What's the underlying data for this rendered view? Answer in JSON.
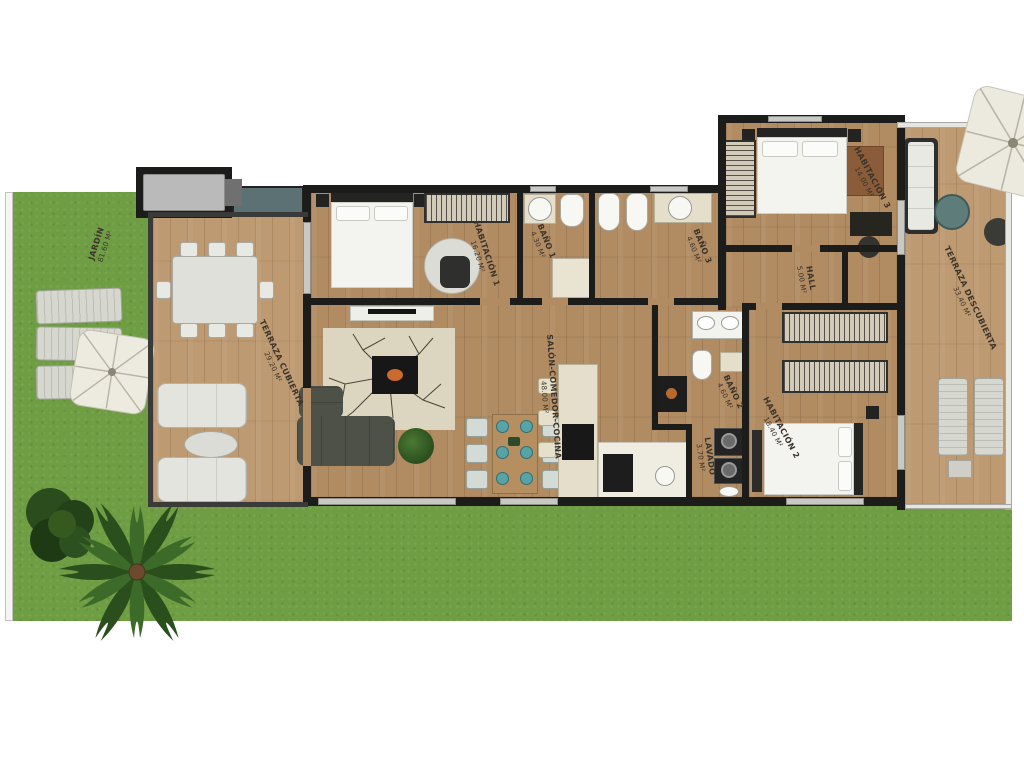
{
  "title": "Apartment floor plan",
  "rooms": [
    {
      "id": "jardin",
      "label": "JARDÍN",
      "area": "81.60 m²"
    },
    {
      "id": "terraza-cubierta",
      "label": "TERRAZA CUBIERTA",
      "area": "29.20 m²"
    },
    {
      "id": "habitacion-1",
      "label": "HABITACIÓN 1",
      "area": "16.20 m²"
    },
    {
      "id": "bano-1",
      "label": "BAÑO 1",
      "area": "4.30 m²"
    },
    {
      "id": "bano-3",
      "label": "BAÑO 3",
      "area": "4.60 m²"
    },
    {
      "id": "habitacion-3",
      "label": "HABITACIÓN 3",
      "area": "14.00 m²"
    },
    {
      "id": "hall",
      "label": "HALL",
      "area": "5.00 m²"
    },
    {
      "id": "terraza-descubierta",
      "label": "TERRAZA DESCUBIERTA",
      "area": "33.40 m²"
    },
    {
      "id": "salon",
      "label": "SALÓN-COMEDOR-COCINA",
      "area": "48.00 m²"
    },
    {
      "id": "bano-2",
      "label": "BAÑO 2",
      "area": "4.60 m²"
    },
    {
      "id": "lavado",
      "label": "LAVADO",
      "area": "3.70 m²"
    },
    {
      "id": "habitacion-2",
      "label": "HABITACIÓN 2",
      "area": "18.40 m²"
    }
  ],
  "colors": {
    "wall": "#1c1c1a",
    "wood_floor": "#b18b62",
    "terrace_wood": "#bd9a71",
    "grass": "#6f9d43",
    "label_text": "#3c342a",
    "planter_teal": "#5c7173",
    "fireplace_stone": "#dcd5bf"
  }
}
